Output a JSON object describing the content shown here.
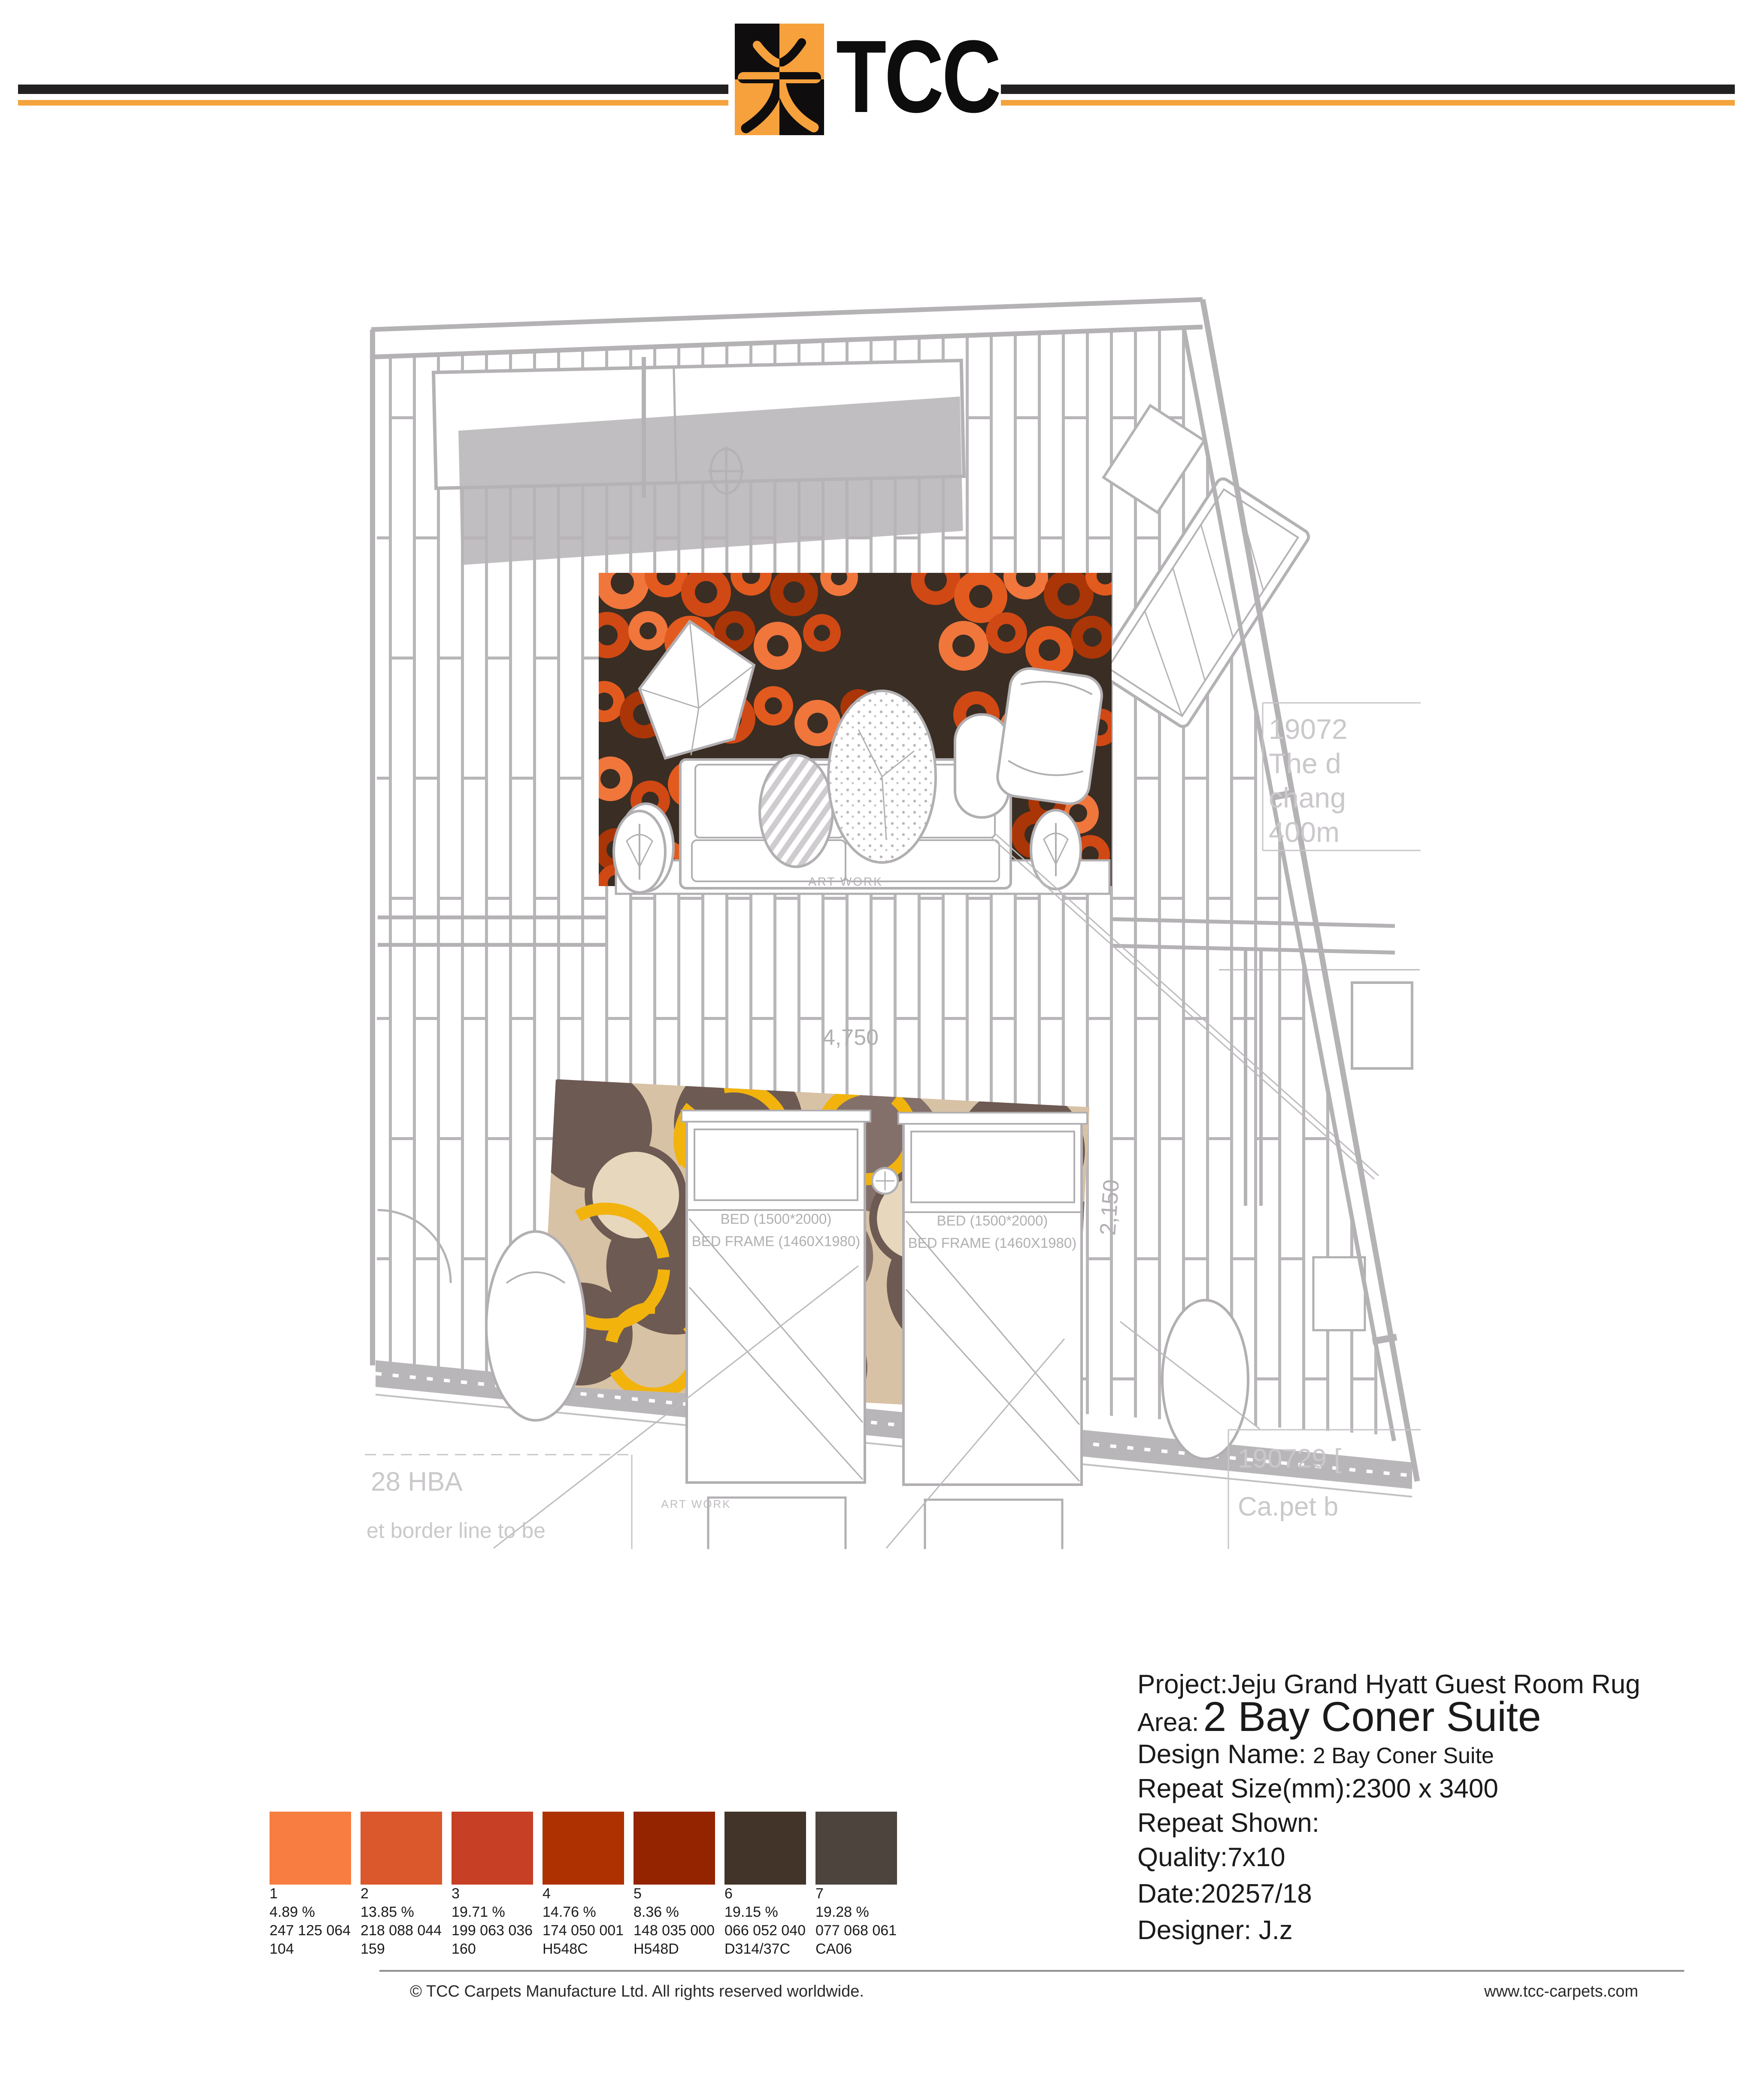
{
  "header": {
    "brand": "TCC"
  },
  "plan": {
    "dim_horizontal": "4,750",
    "dim_vertical": "2,150",
    "artwork_label": "ART WORK",
    "bed_line1": "BED (1500*2000)",
    "bed_line2": "BED FRAME (1460X1980)",
    "notes": {
      "right_edge": [
        "19072",
        "The d",
        "chang",
        "400m"
      ],
      "bottom_left": [
        "28 HBA",
        "et border line to be"
      ],
      "bottom_right": [
        "190729 [",
        "Ca.pet b"
      ]
    }
  },
  "info": {
    "project": "Project:Jeju Grand Hyatt Guest Room Rug",
    "area_label": "Area:",
    "area_value": "2 Bay Coner Suite",
    "design_label": "Design Name:",
    "design_value": "2 Bay Coner Suite",
    "repeat_size": "Repeat Size(mm):2300 x 3400",
    "repeat_shown": "Repeat Shown:",
    "quality": "Quality:7x10",
    "date": "Date:20257/18",
    "designer": "Designer: J.z"
  },
  "palette": {
    "swatches": [
      {
        "n": "1",
        "percent": "4.89  %",
        "rgb": "247 125 064",
        "code": "104",
        "hex": "#f77d40"
      },
      {
        "n": "2",
        "percent": "13.85 %",
        "rgb": "218 088 044",
        "code": "159",
        "hex": "#da582c"
      },
      {
        "n": "3",
        "percent": "19.71 %",
        "rgb": "199 063 036",
        "code": "160",
        "hex": "#c73f24"
      },
      {
        "n": "4",
        "percent": "14.76 %",
        "rgb": "174 050 001",
        "code": "H548C",
        "hex": "#ae3201"
      },
      {
        "n": "5",
        "percent": "8.36  %",
        "rgb": "148 035 000",
        "code": "H548D",
        "hex": "#942300"
      },
      {
        "n": "6",
        "percent": "19.15 %",
        "rgb": "066 052 040",
        "code": "D314/37C",
        "hex": "#423428"
      },
      {
        "n": "7",
        "percent": "19.28 %",
        "rgb": "077 068 061",
        "code": "CA06",
        "hex": "#4d443d"
      }
    ]
  },
  "footer": {
    "copyright": "© TCC Carpets Manufacture Ltd. All rights reserved worldwide.",
    "website": "www.tcc-carpets.com"
  },
  "colors": {
    "accent_orange": "#f4a33d",
    "line_black": "#232021",
    "plan_gray": "#b5b2b5",
    "rug1_bg": "#3a2d23",
    "rug2_bg": "#d8c2a5",
    "rug2_yellow": "#f2b30d"
  }
}
